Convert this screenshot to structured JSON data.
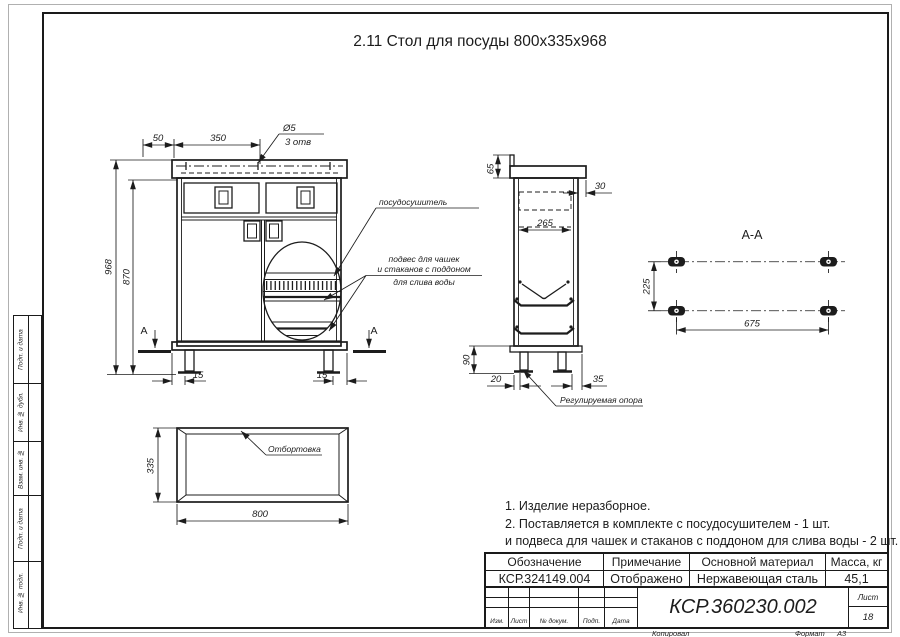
{
  "colors": {
    "ink": "#1c1c1c",
    "frame": "#1a1a1a",
    "paper": "#ffffff"
  },
  "title": "2.11 Стол для посуды 800х335х968",
  "front_view": {
    "dim_top_left": "50",
    "dim_top_right": "350",
    "hole_diameter": "Ø5",
    "hole_count": "3 отв",
    "dim_height_total": "968",
    "dim_height_body": "870",
    "dim_leg_left": "15",
    "dim_leg_right": "15",
    "section_mark_left": "А",
    "section_mark_right": "А"
  },
  "side_view": {
    "dim_top_height": "65",
    "dim_overhang": "30",
    "dim_drawer_depth": "265",
    "dim_leg_height": "90",
    "dim_leg_offset_left": "20",
    "dim_leg_offset_right": "35",
    "support_label": "Регулируемая опора"
  },
  "section_view": {
    "title": "А-А",
    "dim_width": "225",
    "dim_length": "675"
  },
  "plan_view": {
    "dim_depth": "335",
    "dim_length": "800",
    "flange_label": "Отбортовка"
  },
  "callouts": {
    "dryer": "посудосушитель",
    "hanger_line1": "подвес для чашек",
    "hanger_line2": "и стаканов с поддоном",
    "hanger_line3": "для слива воды"
  },
  "notes": {
    "line1": "1. Изделие неразборное.",
    "line2": "2. Поставляется в комплекте с посудосушителем - 1 шт.",
    "line3": "и подвеса для чашек и стаканов с поддоном для слива воды - 2 шт."
  },
  "title_block": {
    "col_designation": "Обозначение",
    "col_note": "Примечание",
    "col_material": "Основной материал",
    "col_mass": "Масса, кг",
    "val_designation": "КСР.324149.004",
    "val_note": "Отображено",
    "val_material": "Нержавеющая сталь",
    "val_mass": "45,1",
    "doc_number": "КСР.360230.002",
    "sheet_label": "Лист",
    "sheet_value": "18",
    "rev_labels": {
      "izm": "Изм.",
      "list": "Лист",
      "doc": "№ докум.",
      "podp": "Подп.",
      "data": "Дата"
    },
    "footer": {
      "copied": "Копировал",
      "format_label": "Формат",
      "format_value": "А3"
    }
  },
  "margin_labels": {
    "l1": "Подп. и дата",
    "l2": "Инв. № дубл.",
    "l3": "Взам. инв. №",
    "l4": "Подп. и дата",
    "l5": "Инв. № подл."
  }
}
